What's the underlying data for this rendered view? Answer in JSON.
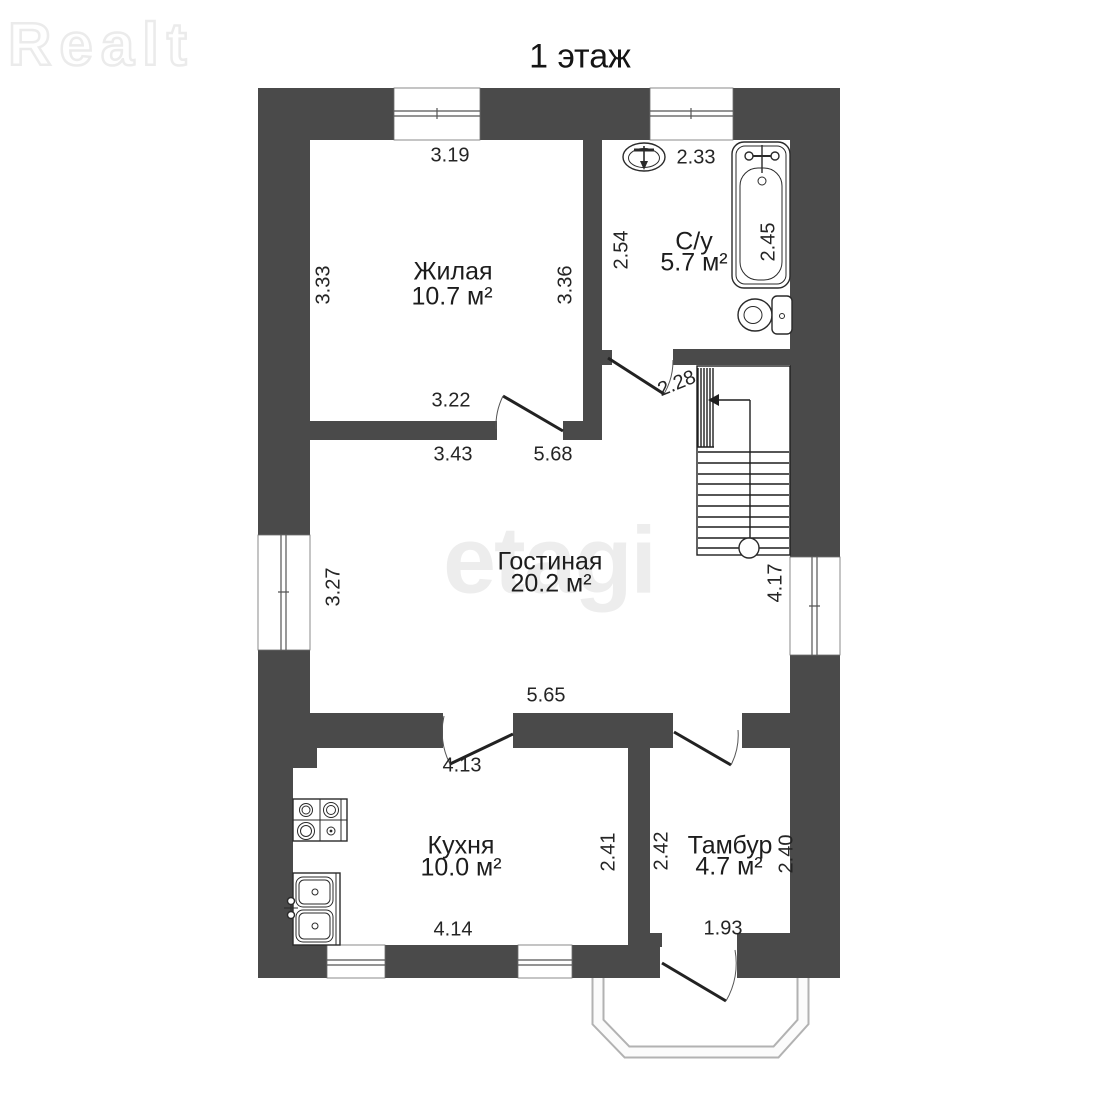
{
  "title": "1 этаж",
  "watermarks": {
    "brand": "Realt",
    "center": "etagi"
  },
  "colors": {
    "wall": "#4a4a4a",
    "line": "#1f1f1f",
    "watermark": "#ededed"
  },
  "rooms": {
    "zhilaya": {
      "name": "Жилая",
      "area": "10.7 м²"
    },
    "su": {
      "name": "С/у",
      "area": "5.7 м²"
    },
    "gostinaya": {
      "name": "Гостиная",
      "area": "20.2 м²"
    },
    "kuhnya": {
      "name": "Кухня",
      "area": "10.0 м²"
    },
    "tambur": {
      "name": "Тамбур",
      "area": "4.7 м²"
    }
  },
  "dimensions": {
    "zhilaya_top": "3.19",
    "zhilaya_left": "3.33",
    "zhilaya_right": "3.36",
    "zhilaya_bottom": "3.22",
    "su_top": "2.33",
    "su_left": "2.54",
    "bath": "2.45",
    "su_door": "2.28",
    "gost_seg1": "3.43",
    "gost_seg2": "5.68",
    "gost_left": "3.27",
    "gost_bottom": "5.65",
    "stairs_right": "4.17",
    "kitchen_top": "4.13",
    "kitchen_right": "2.41",
    "kitchen_bottom": "4.14",
    "tambur_left": "2.42",
    "tambur_right": "2.40",
    "tambur_bottom": "1.93"
  }
}
